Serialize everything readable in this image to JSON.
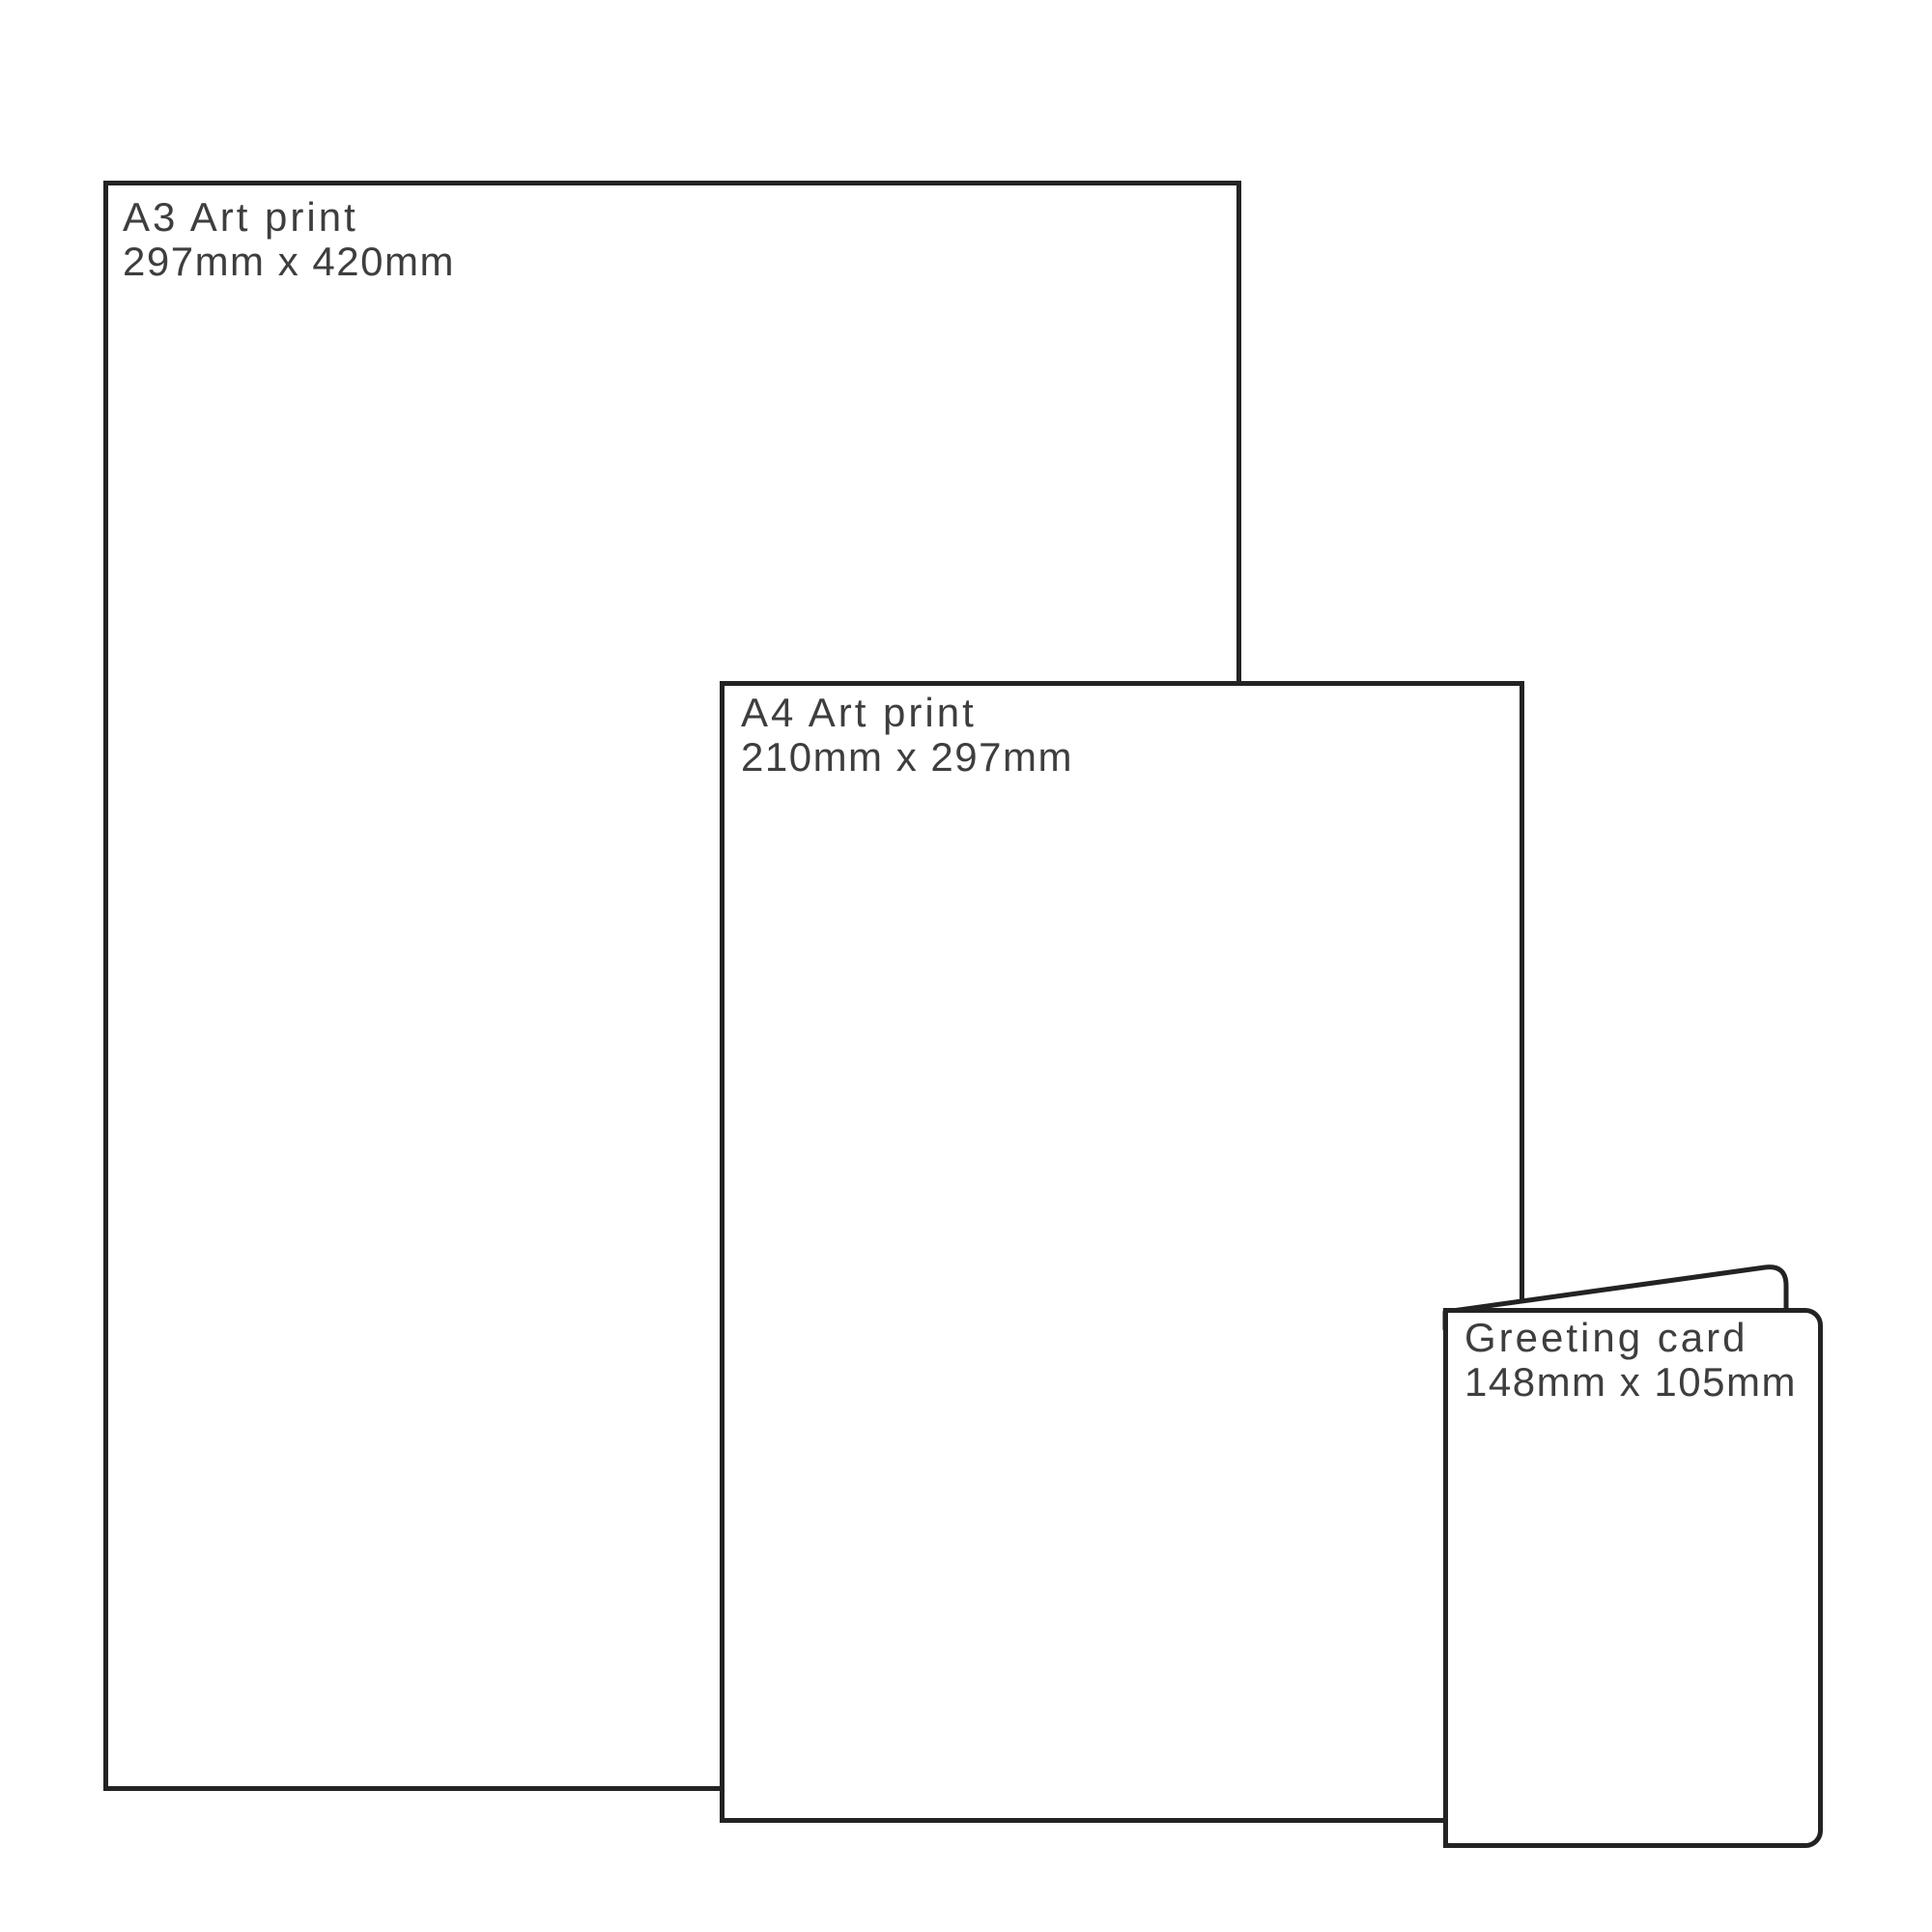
{
  "colors": {
    "line": "#232323",
    "text": "#3e3e40",
    "background": "#ffffff"
  },
  "diagram": {
    "description": "Print size comparison diagram",
    "items": [
      {
        "name": "A3 Art print",
        "size": "297mm x 420mm"
      },
      {
        "name": "A4 Art print",
        "size": "210mm x 297mm"
      },
      {
        "name": "Greeting card",
        "size": "148mm x 105mm"
      }
    ]
  }
}
